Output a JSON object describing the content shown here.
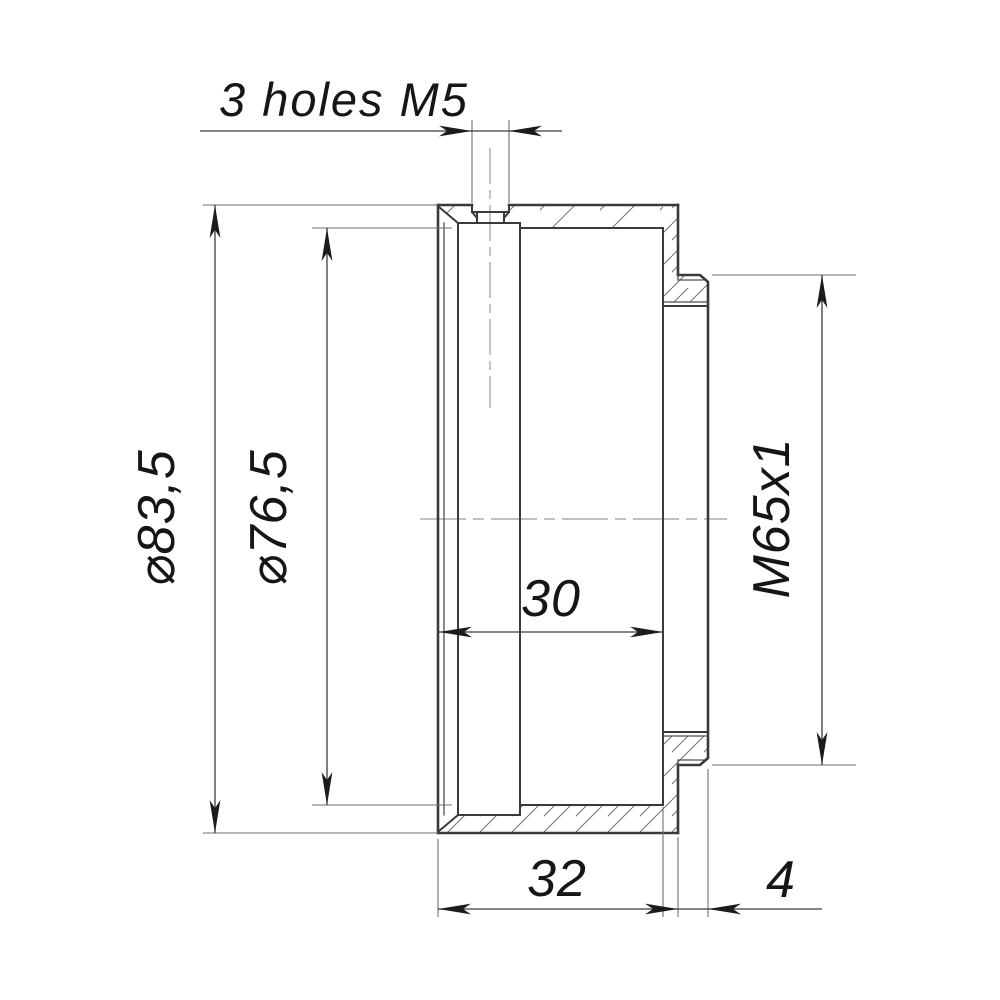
{
  "drawing": {
    "type": "technical-section-drawing",
    "part": "threaded cylindrical adapter, cross-section view",
    "background_color": "#ffffff",
    "outline_color": "#3a3a3a",
    "dimension_color": "#3c3c3c",
    "arrow_color": "#1c1c1c",
    "text_color": "#161616",
    "centerline_color": "#9c9c9c",
    "labels": {
      "holes_note": "3 holes M5",
      "outer_diameter": "⌀83,5",
      "inner_diameter": "⌀76,5",
      "bore_depth": "30",
      "thread": "M65x1",
      "body_length": "32",
      "thread_length": "4"
    },
    "dimensions": [
      {
        "name": "outer-diameter",
        "value": "⌀83,5",
        "orientation": "vertical"
      },
      {
        "name": "inner-diameter",
        "value": "⌀76,5",
        "orientation": "vertical"
      },
      {
        "name": "thread-designation",
        "value": "M65x1",
        "orientation": "vertical"
      },
      {
        "name": "bore-depth",
        "value": "30",
        "orientation": "horizontal"
      },
      {
        "name": "body-length",
        "value": "32",
        "orientation": "horizontal"
      },
      {
        "name": "thread-section-length",
        "value": "4",
        "orientation": "horizontal"
      },
      {
        "name": "radial-holes",
        "value": "3 holes M5",
        "orientation": "horizontal"
      }
    ]
  }
}
